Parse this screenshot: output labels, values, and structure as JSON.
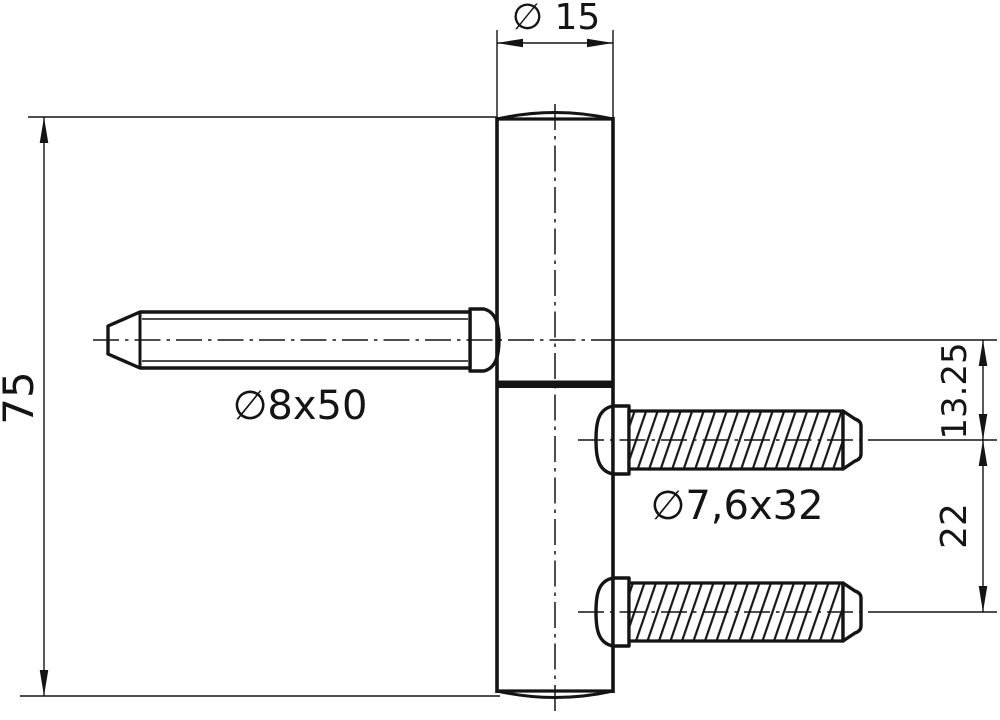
{
  "drawing": {
    "title": "Hinge technical drawing",
    "labels": {
      "barrel_diameter": "∅ 15",
      "overall_length": "75",
      "pin_size": "∅8x50",
      "screw_size": "∅7,6x32",
      "pin_to_screw_offset": "13.25",
      "screw_spacing": "22"
    },
    "colors": {
      "line": "#141414",
      "background": "#ffffff"
    }
  }
}
